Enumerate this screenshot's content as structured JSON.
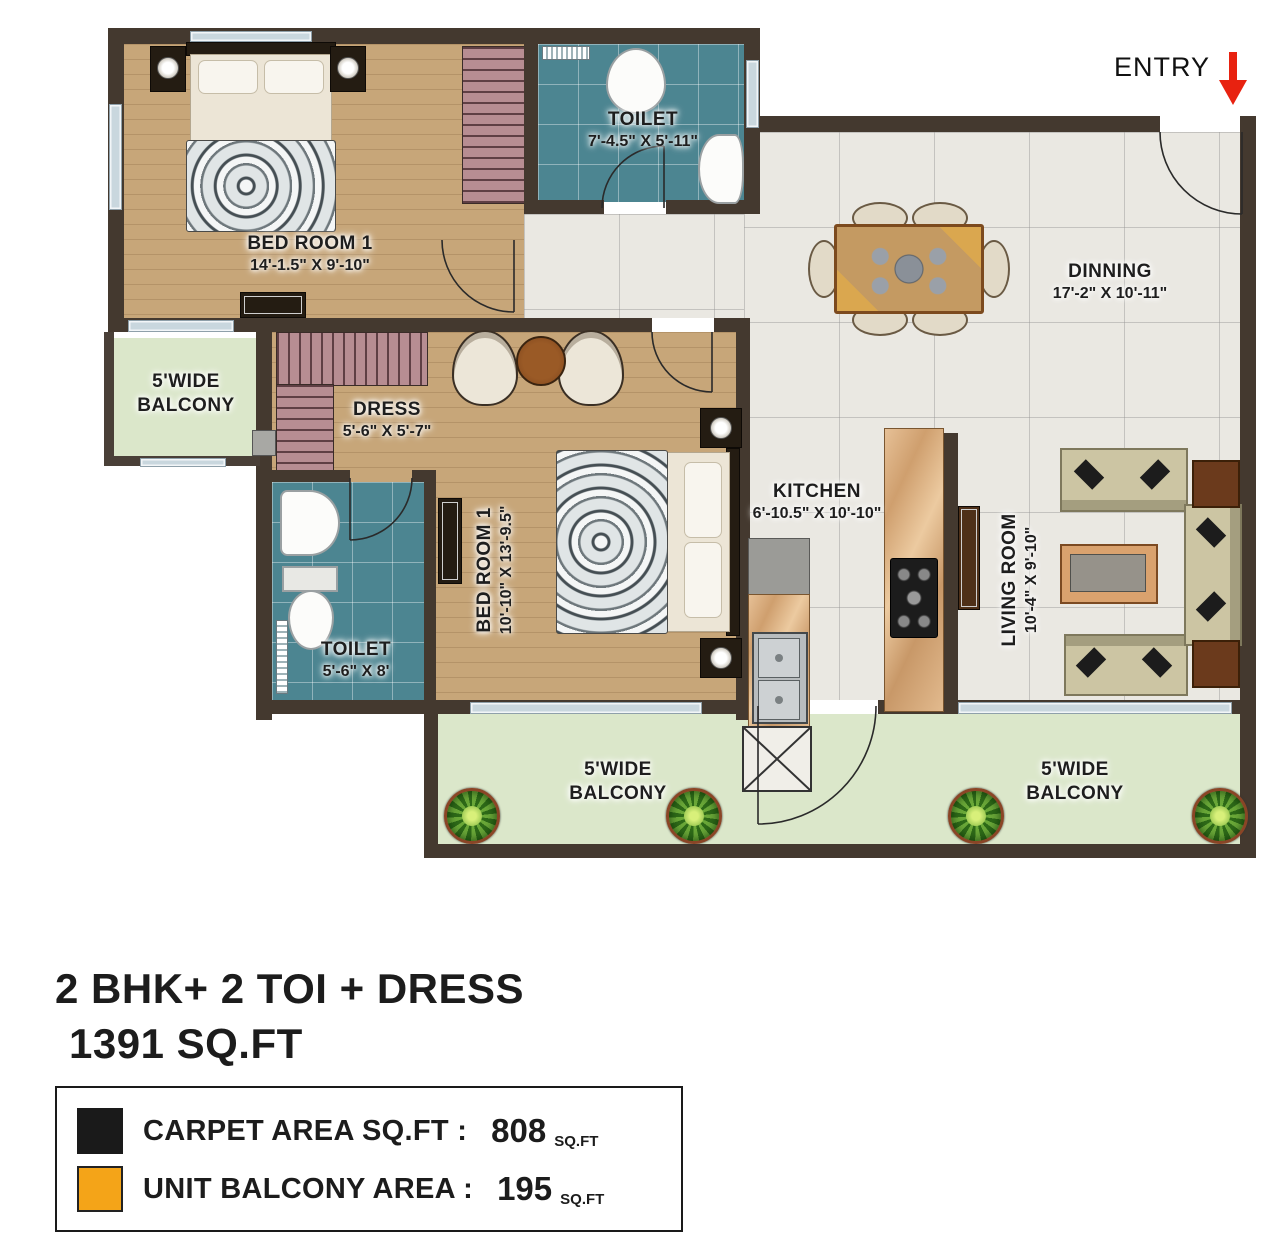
{
  "entry": {
    "label": "ENTRY"
  },
  "rooms": {
    "bedroom1": {
      "name": "BED  ROOM  1",
      "dims": "14'-1.5\" X 9'-10\""
    },
    "toilet1": {
      "name": "TOILET",
      "dims": "7'-4.5\" X 5'-11\""
    },
    "balcony_left": {
      "line1": "5'WIDE",
      "line2": "BALCONY"
    },
    "dress": {
      "name": "DRESS",
      "dims": "5'-6\" X 5'-7\""
    },
    "bedroom2": {
      "name": "BED  ROOM  1",
      "dims": "10'-10\" X 13'-9.5\""
    },
    "toilet2": {
      "name": "TOILET",
      "dims": "5'-6\" X 8'"
    },
    "dining": {
      "name": "DINNING",
      "dims": "17'-2\" X 10'-11\""
    },
    "kitchen": {
      "name": "KITCHEN",
      "dims": "6'-10.5\" X 10'-10\""
    },
    "living": {
      "name": "LIVING  ROOM",
      "dims": "10'-4\" X 9'-10\""
    },
    "balcony_bottom_left": {
      "line1": "5'WIDE",
      "line2": "BALCONY"
    },
    "balcony_bottom_right": {
      "line1": "5'WIDE",
      "line2": "BALCONY"
    }
  },
  "summary": {
    "title_line1": "2 BHK+ 2 TOI + DRESS",
    "title_line2": "1391 SQ.FT"
  },
  "legend": {
    "items": [
      {
        "label": "CARPET AREA SQ.FT :",
        "value": "808",
        "unit": "SQ.FT",
        "swatch_color": "#1a1a1a"
      },
      {
        "label": "UNIT BALCONY AREA :",
        "value": "195",
        "unit": "SQ.FT",
        "swatch_color": "#f4a418"
      }
    ]
  },
  "colors": {
    "wall": "#44392f",
    "wood_floor": "#c7a679",
    "teal_tile": "#4c8591",
    "white_tile": "#eae8e2",
    "balcony_green": "#dbe7ca",
    "wardrobe_stripe": "#b78d92",
    "entry_arrow_red": "#e82210"
  }
}
